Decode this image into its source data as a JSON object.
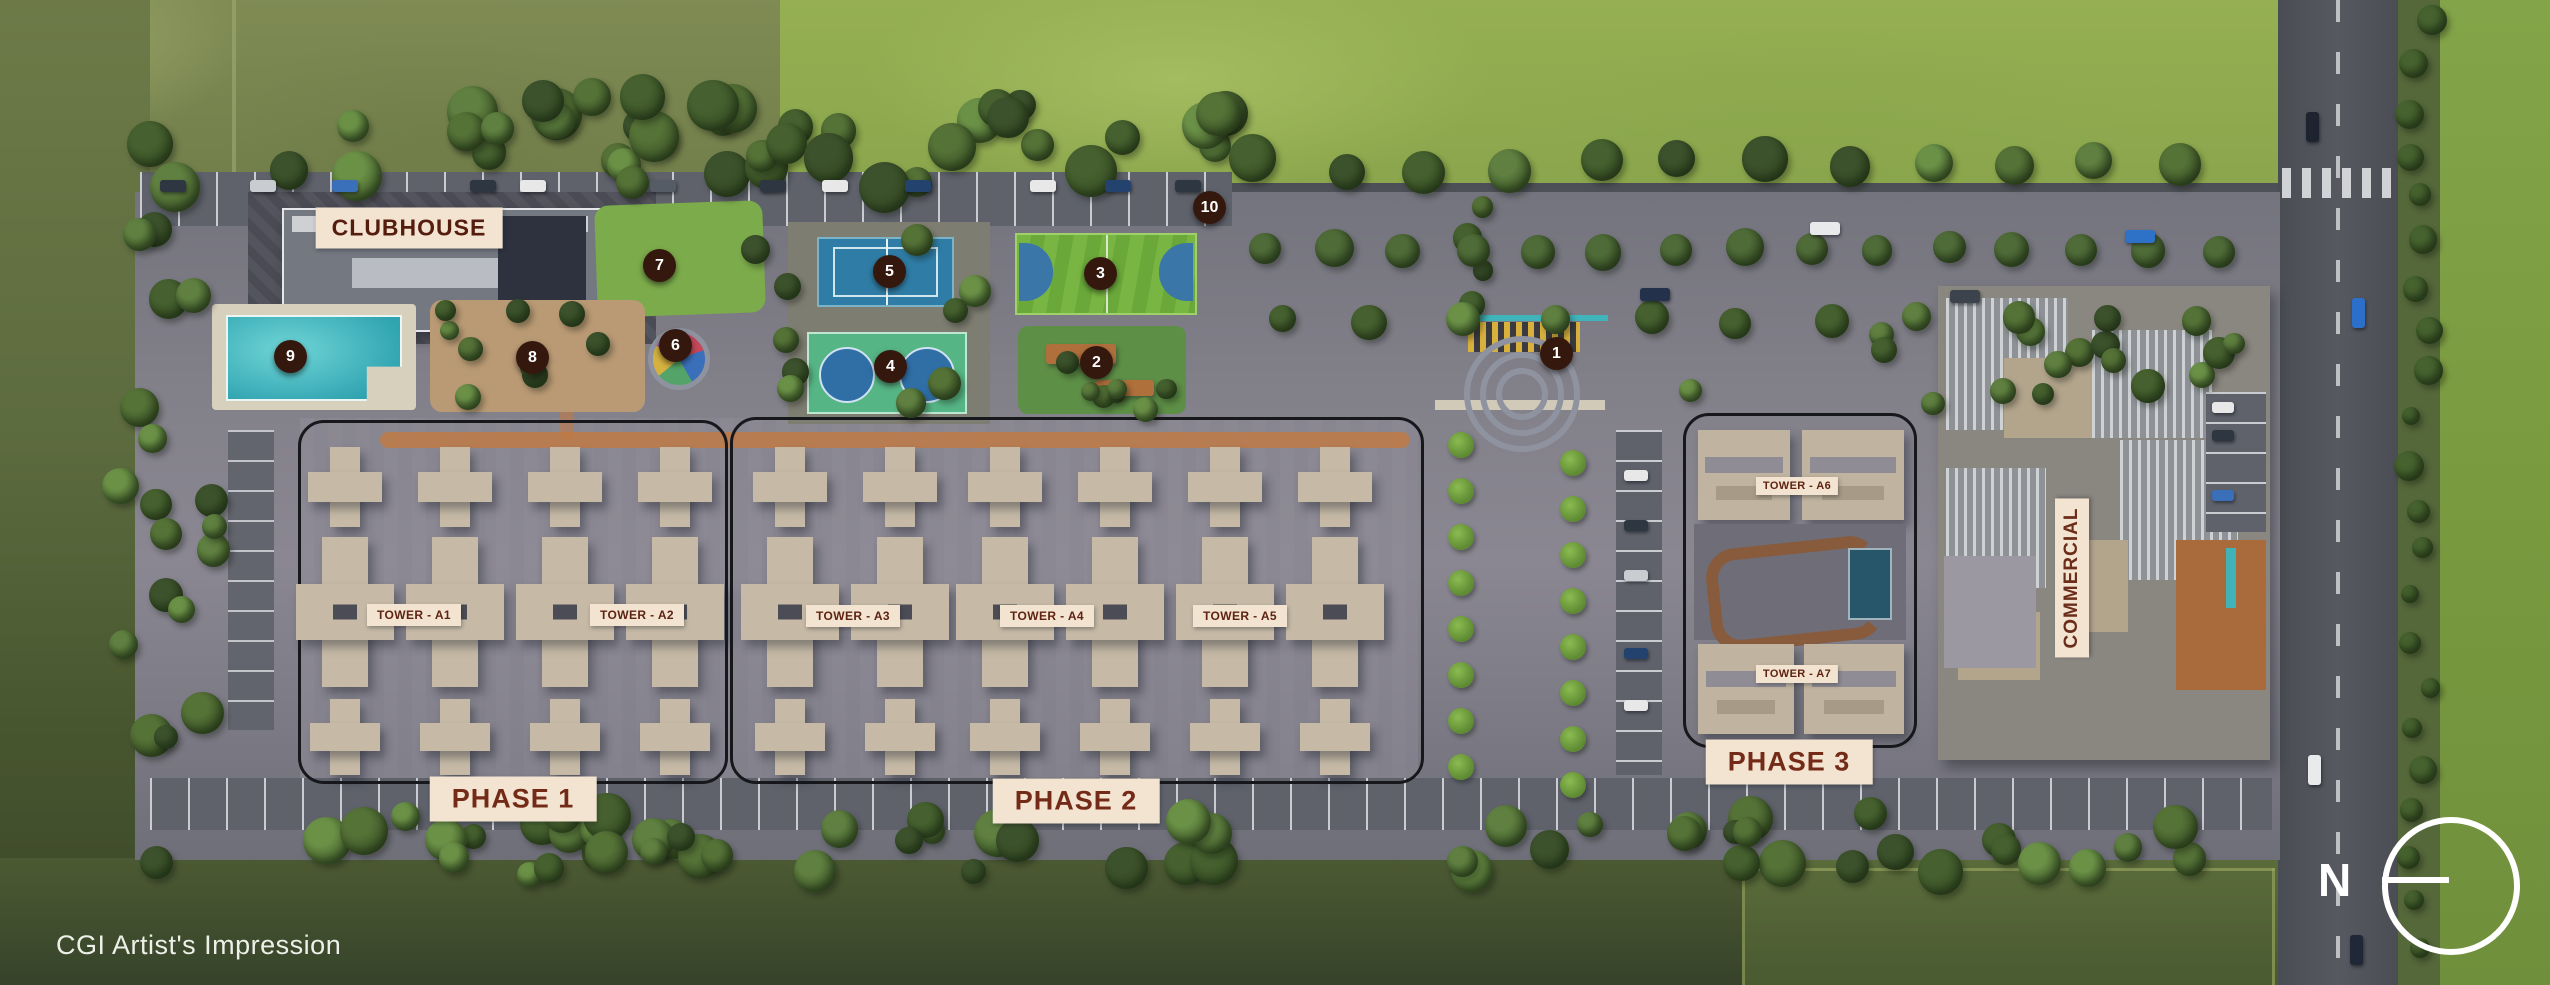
{
  "map": {
    "clubhouse_label": "CLUBHOUSE",
    "commercial_label": "COMMERCIAL",
    "cgi_note": "CGI Artist's Impression",
    "north_label": "N"
  },
  "phases": [
    {
      "label": "PHASE 1",
      "x": 513,
      "y": 799
    },
    {
      "label": "PHASE 2",
      "x": 1076,
      "y": 801
    },
    {
      "label": "PHASE 3",
      "x": 1789,
      "y": 762
    }
  ],
  "towers": [
    {
      "label": "TOWER - A1",
      "x": 414,
      "y": 615,
      "size": "normal"
    },
    {
      "label": "TOWER - A2",
      "x": 637,
      "y": 615,
      "size": "normal"
    },
    {
      "label": "TOWER - A3",
      "x": 853,
      "y": 616,
      "size": "normal"
    },
    {
      "label": "TOWER - A4",
      "x": 1047,
      "y": 616,
      "size": "normal"
    },
    {
      "label": "TOWER - A5",
      "x": 1240,
      "y": 616,
      "size": "normal"
    },
    {
      "label": "TOWER - A6",
      "x": 1797,
      "y": 486,
      "size": "small"
    },
    {
      "label": "TOWER - A7",
      "x": 1797,
      "y": 674,
      "size": "small"
    }
  ],
  "markers": [
    {
      "n": "1",
      "x": 1556,
      "y": 353
    },
    {
      "n": "2",
      "x": 1096,
      "y": 362
    },
    {
      "n": "3",
      "x": 1100,
      "y": 273
    },
    {
      "n": "4",
      "x": 890,
      "y": 366
    },
    {
      "n": "5",
      "x": 889,
      "y": 271
    },
    {
      "n": "6",
      "x": 675,
      "y": 345
    },
    {
      "n": "7",
      "x": 659,
      "y": 265
    },
    {
      "n": "8",
      "x": 532,
      "y": 357
    },
    {
      "n": "9",
      "x": 290,
      "y": 356
    },
    {
      "n": "10",
      "x": 1209,
      "y": 207
    }
  ],
  "colors": {
    "label_bg": "#f3e4d1",
    "label_text": "#5e2312",
    "phase_text": "#732b18",
    "marker_bg": "#34180e",
    "marker_text": "#ffffff"
  }
}
